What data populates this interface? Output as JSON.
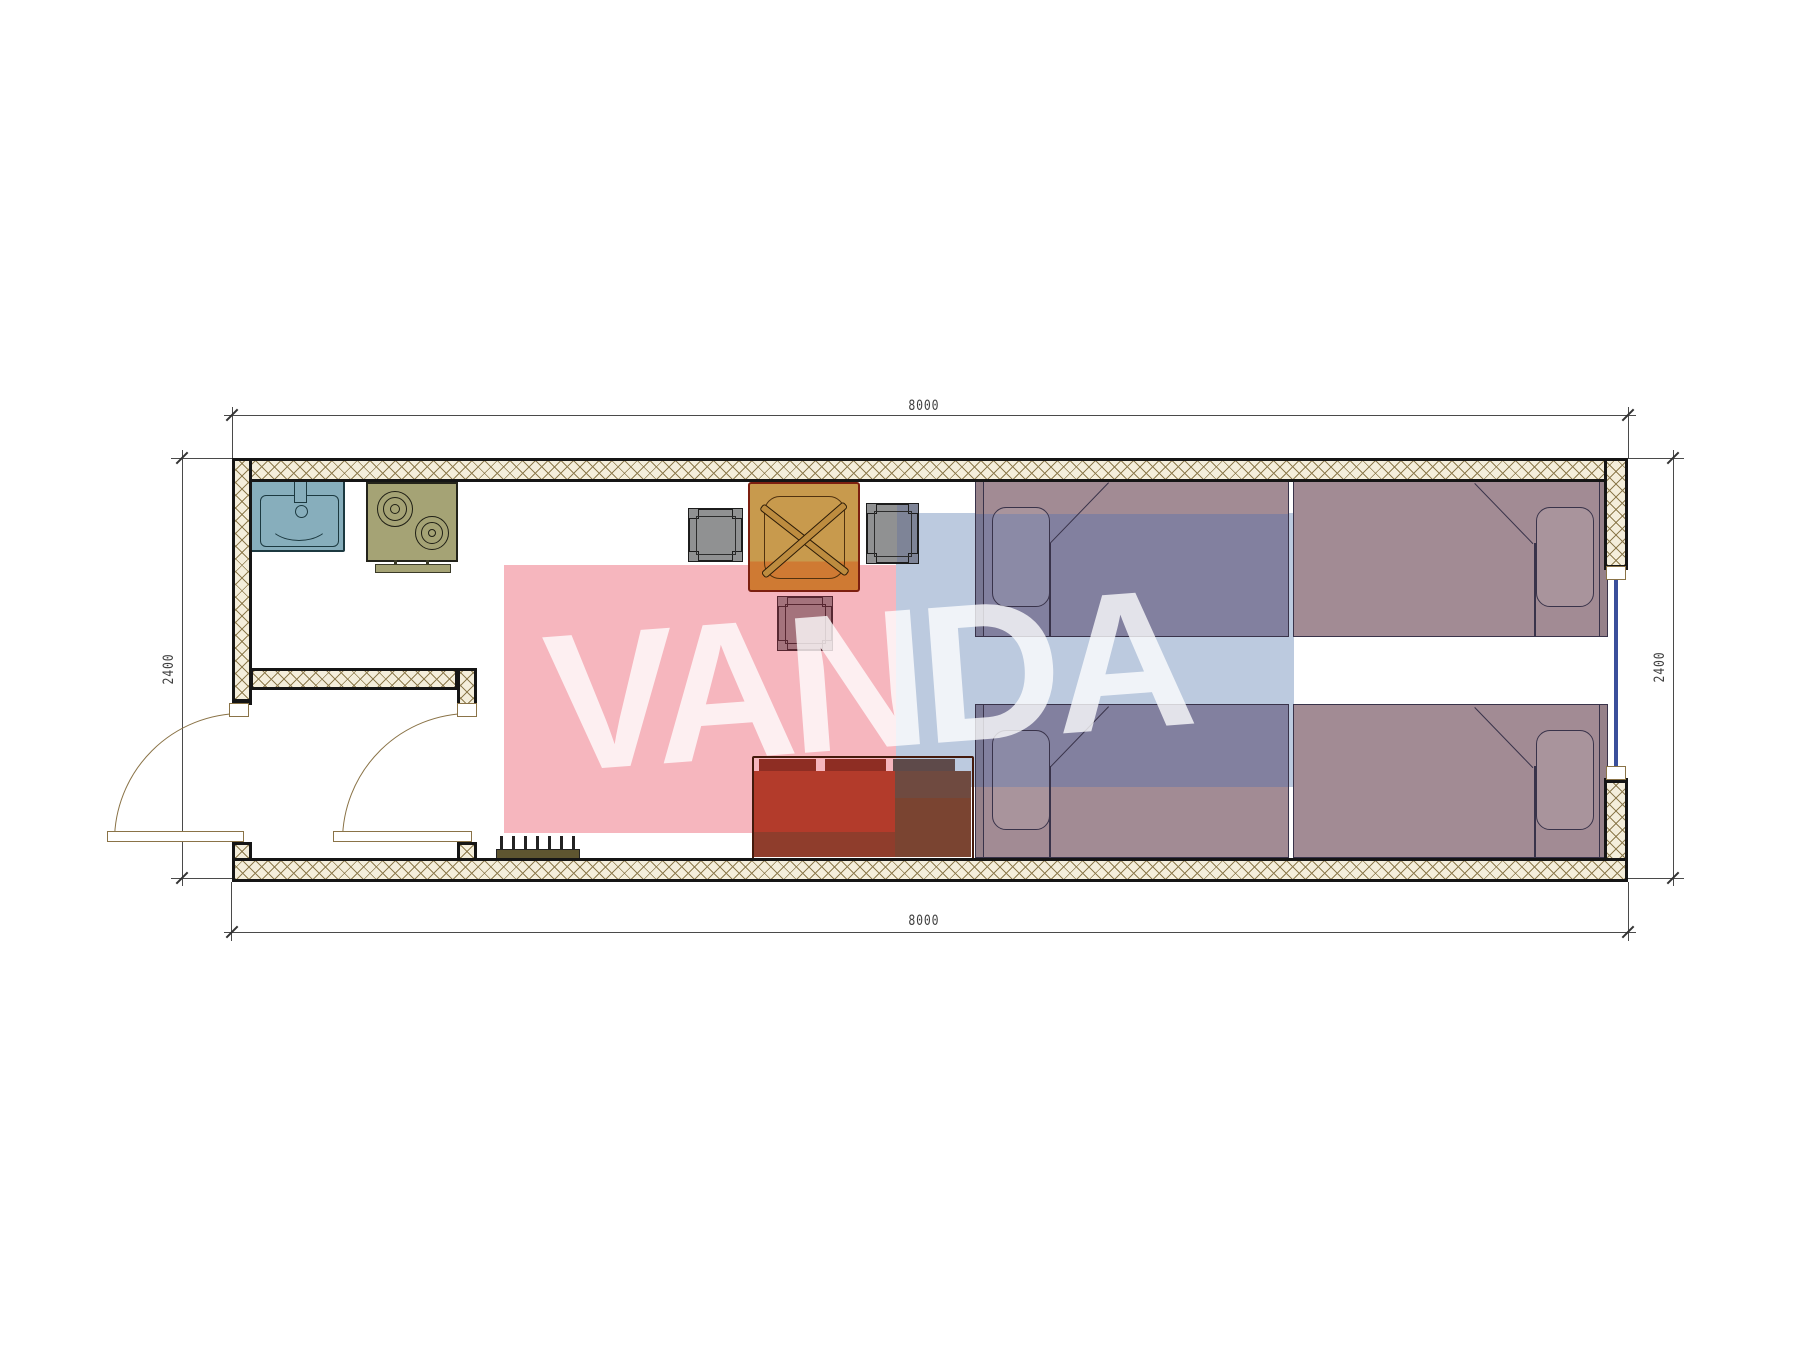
{
  "document": {
    "type": "architectural-floor-plan",
    "subject": "single-module container house plan view",
    "units": "mm",
    "background": "#ffffff"
  },
  "dimensions": {
    "top": "8000",
    "bottom": "8000",
    "left": "2400",
    "right": "2400"
  },
  "watermark": {
    "text": "VANDA",
    "text_color": "#ffffff",
    "pink_rect_color": "#f6b6be",
    "blue_rect_color": "#bccadf"
  },
  "colors": {
    "wall_outline": "#151515",
    "wall_hatch_line": "#8d7b4e",
    "wall_fill": "#f4eedb",
    "dimension_line": "#4a4a4a",
    "door_line": "#8a7347",
    "sink": "#87aebc",
    "stove": "#a5a375",
    "table_top": "#c89a4d",
    "table_bottom_tinted": "#cf7a33",
    "chair": "#909192",
    "stool": "#a4737c",
    "sofa_left_tinted": "#b33b2b",
    "sofa_right": "#7a4733",
    "bed_natural": "#a28b94",
    "bed_blue_tinted": "#82809f",
    "window_glass": "#3a4f9b"
  },
  "furniture": [
    {
      "name": "sink",
      "location": "kitchen top-left"
    },
    {
      "name": "stove",
      "location": "kitchen, right of sink",
      "burners": 2
    },
    {
      "name": "dining-table",
      "location": "top center"
    },
    {
      "name": "chair-left",
      "location": "left of table"
    },
    {
      "name": "chair-right",
      "location": "right of table"
    },
    {
      "name": "stool",
      "location": "below table"
    },
    {
      "name": "sofa",
      "location": "bottom center",
      "seats": 3
    },
    {
      "name": "bed-top-left",
      "pillow": "left"
    },
    {
      "name": "bed-top-right",
      "pillow": "right"
    },
    {
      "name": "bed-bottom-left",
      "pillow": "left"
    },
    {
      "name": "bed-bottom-right",
      "pillow": "right"
    },
    {
      "name": "shoe-rack",
      "location": "bottom wall near entry"
    }
  ],
  "openings": [
    {
      "name": "entry-door",
      "wall": "left",
      "swing": "outward"
    },
    {
      "name": "interior-door",
      "wall": "vestibule partition",
      "swing": "inward"
    },
    {
      "name": "window",
      "wall": "right"
    }
  ]
}
